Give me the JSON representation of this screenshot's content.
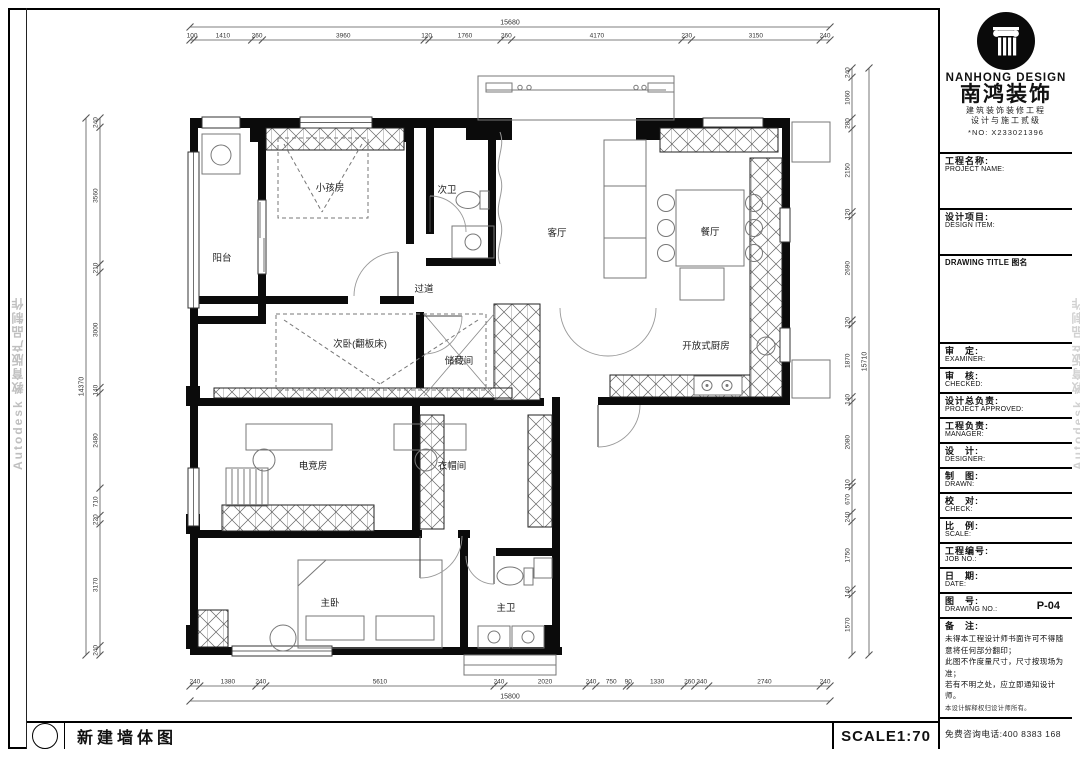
{
  "sheet": {
    "drawing_title": "新建墙体图",
    "scale_label": "SCALE1:70",
    "watermark": "Autodesk 教育版产品制作"
  },
  "title_block": {
    "brand_en": "NANHONG DESIGN",
    "brand_cn": "南鸿装饰",
    "cert_line1": "建筑装饰装修工程",
    "cert_line2": "设计与施工贰级",
    "cert_no": "*NO: X233021396",
    "drawing_title_label": "DRAWING TITLE 图名",
    "drawing_no_value": "P-04",
    "remarks_title": "备　注:",
    "remarks": [
      "未得本工程设计师书面许可不得随意将任何部分翻印；",
      "此图不作度量尺寸，尺寸按现场为准；",
      "若有不明之处，应立即通知设计师。",
      "本设计解释权归设计师所有。"
    ],
    "phone": "免费咨询电话:400 8383 168",
    "fields": {
      "project_name": {
        "cn": "工程名称:",
        "en": "PROJECT NAME:"
      },
      "design_item": {
        "cn": "设计项目:",
        "en": "DESIGN ITEM:"
      },
      "examiner": {
        "cn": "审　定:",
        "en": "EXAMINER:"
      },
      "checked": {
        "cn": "审　核:",
        "en": "CHECKED:"
      },
      "project_approved": {
        "cn": "设计总负责:",
        "en": "PROJECT APPROVED:"
      },
      "manager": {
        "cn": "工程负责:",
        "en": "MANAGER:"
      },
      "designer": {
        "cn": "设　计:",
        "en": "DESIGNER:"
      },
      "drawn": {
        "cn": "制　图:",
        "en": "DRAWN:"
      },
      "check": {
        "cn": "校　对:",
        "en": "CHECK:"
      },
      "scale": {
        "cn": "比　例:",
        "en": "SCALE:"
      },
      "job_no": {
        "cn": "工程编号:",
        "en": "JOB NO.:"
      },
      "date": {
        "cn": "日　期:",
        "en": "DATE:"
      },
      "drawing_no": {
        "cn": "图　号:",
        "en": "DRAWING NO.:"
      }
    }
  },
  "rooms": {
    "balcony": "阳台",
    "kids_room": "小孩房",
    "bath2": "次卫",
    "living": "客厅",
    "dining": "餐厅",
    "hallway": "过道",
    "bedroom2": "次卧(翻板床)",
    "storage": "储藏间",
    "kitchen": "开放式厨房",
    "gaming": "电竞房",
    "cloakroom": "衣帽间",
    "master": "主卧",
    "bath1": "主卫"
  },
  "dimensions": {
    "top": {
      "total": 15680,
      "segments": [
        100,
        1410,
        260,
        3960,
        120,
        1760,
        260,
        4170,
        230,
        3150,
        240
      ]
    },
    "bottom": {
      "total": 15800,
      "segments": [
        240,
        1380,
        240,
        5610,
        240,
        2020,
        240,
        750,
        90,
        1330,
        260,
        340,
        2740,
        240
      ]
    },
    "left": {
      "total": 14370,
      "segments": [
        240,
        3560,
        210,
        3000,
        140,
        2480,
        710,
        220,
        3170,
        240
      ]
    },
    "right": {
      "total": 15710,
      "segments": [
        240,
        1060,
        280,
        2150,
        120,
        2690,
        120,
        1870,
        140,
        2080,
        110,
        670,
        240,
        1750,
        140,
        1570
      ]
    }
  }
}
